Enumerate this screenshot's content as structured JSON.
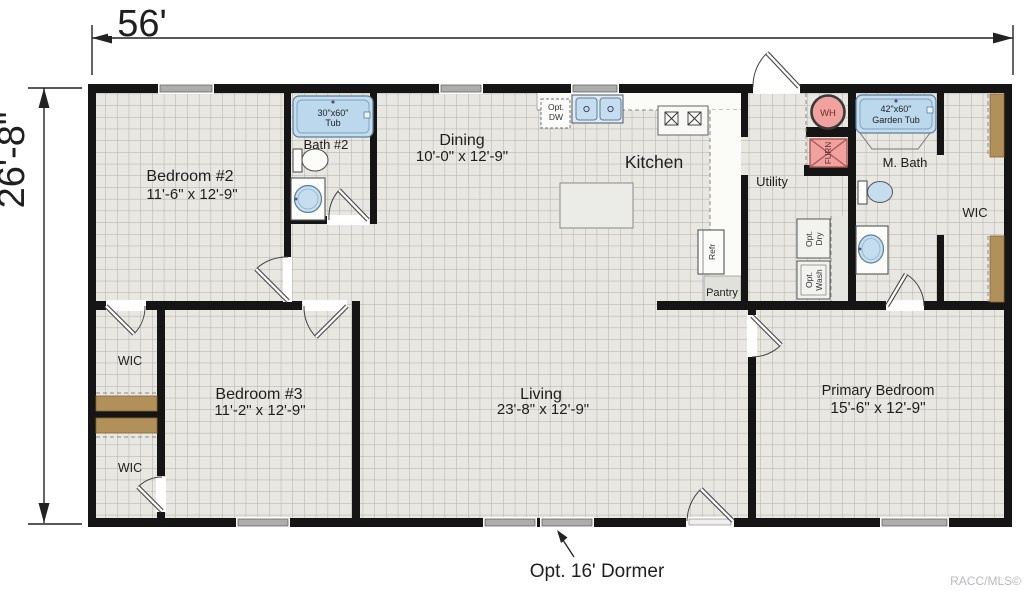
{
  "dimensions": {
    "width_label": "56'",
    "depth_label": "26'-8\""
  },
  "rooms": {
    "bedroom2": {
      "name": "Bedroom #2",
      "size": "11'-6\" x 12'-9\""
    },
    "bath2": {
      "name": "Bath #2"
    },
    "dining": {
      "name": "Dining",
      "size": "10'-0\" x 12'-9\""
    },
    "kitchen": {
      "name": "Kitchen"
    },
    "utility": {
      "name": "Utility"
    },
    "mbath": {
      "name": "M. Bath"
    },
    "wic_right": {
      "name": "WIC"
    },
    "wic_upper": {
      "name": "WIC"
    },
    "wic_lower": {
      "name": "WIC"
    },
    "bedroom3": {
      "name": "Bedroom #3",
      "size": "11'-2\" x 12'-9\""
    },
    "living": {
      "name": "Living",
      "size": "23'-8\" x 12'-9\""
    },
    "primary": {
      "name": "Primary Bedroom",
      "size": "15'-6\" x 12'-9\""
    },
    "pantry": {
      "name": "Pantry"
    }
  },
  "fixtures": {
    "tub": [
      "30\"x60\"",
      "Tub"
    ],
    "garden_tub": [
      "42\"x60\"",
      "Garden Tub"
    ],
    "water_heater": "WH",
    "furnace": "FURN",
    "dishwasher": [
      "Opt.",
      "DW"
    ],
    "refrigerator": "Refr",
    "dryer": [
      "Opt.",
      "Dry"
    ],
    "washer": [
      "Opt.",
      "Wash"
    ]
  },
  "annotations": {
    "dormer": "Opt. 16' Dormer",
    "watermark": "RACC/MLS©"
  },
  "colors": {
    "floor": "#e9e7e1",
    "grid_line": "#9b9b95",
    "wall": "#151515",
    "fixture_blue": "#c5ddee",
    "mechanical_pink": "#f1a19e",
    "shelf_brown": "#b29059",
    "window_gray": "#adadad",
    "watermark_gray": "#b9b9bd"
  }
}
